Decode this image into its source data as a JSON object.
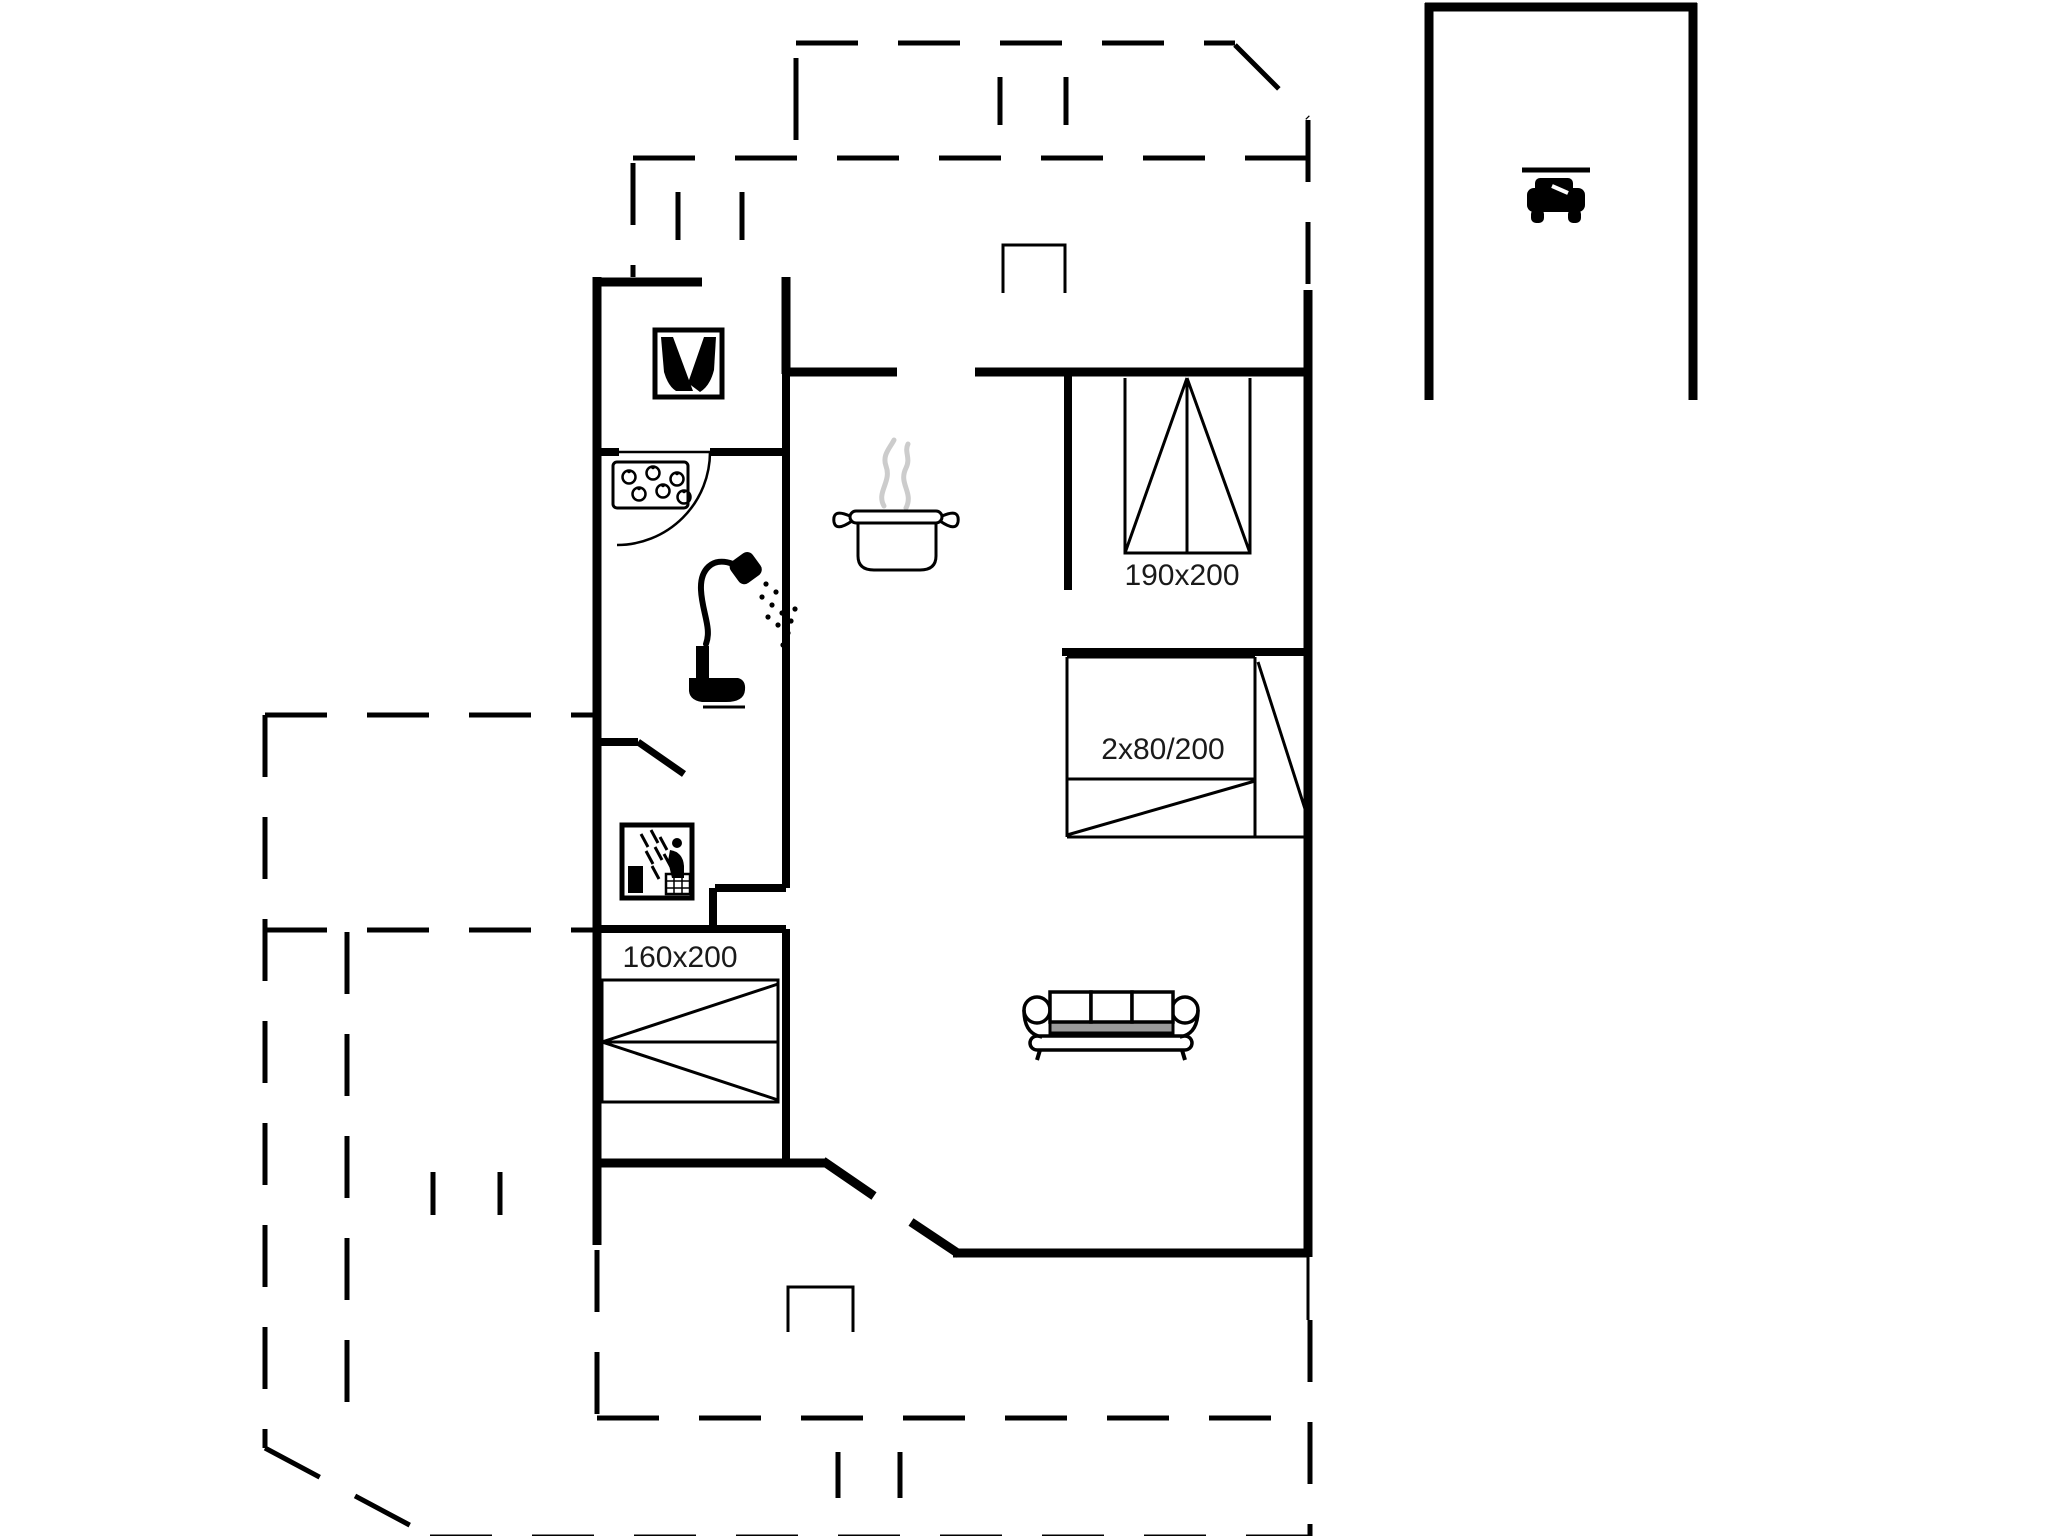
{
  "plan": {
    "type": "holiday-house-floor-plan",
    "colors": {
      "background": "#ffffff",
      "lines": "#000000",
      "text": "#1a1a1a",
      "steam": "#cccccc",
      "sofa_shade": "#9a9a9a"
    },
    "bed_labels": {
      "double_bed": "190x200",
      "bunk_bed": "2x80/200",
      "master_bed": "160x200"
    },
    "icons": [
      "fireplace-icon",
      "hob-icon",
      "shower-icon",
      "toilet-icon",
      "sauna-icon",
      "cooking-pot-icon",
      "sofa-icon",
      "car-icon",
      "door-swing-arc",
      "terrace-step-markers",
      "window-marks"
    ]
  }
}
